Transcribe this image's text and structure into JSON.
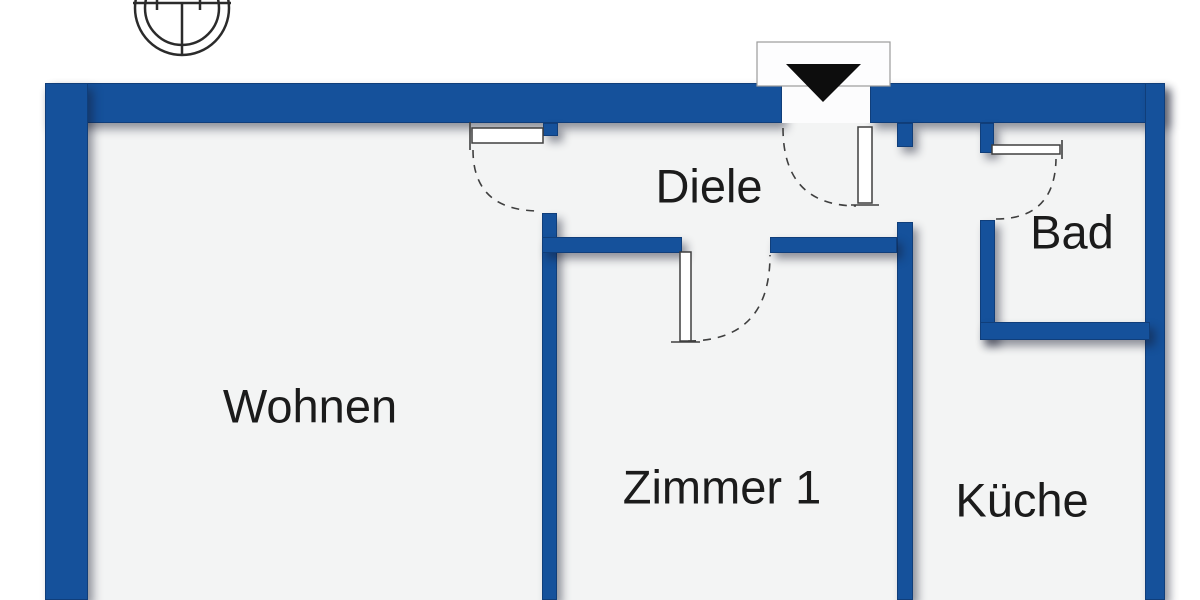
{
  "rooms": [
    {
      "id": "wohnen",
      "label": "Wohnen"
    },
    {
      "id": "diele",
      "label": "Diele"
    },
    {
      "id": "zimmer-1",
      "label": "Zimmer 1"
    },
    {
      "id": "bad",
      "label": "Bad"
    },
    {
      "id": "kueche",
      "label": "Küche"
    }
  ],
  "icons": {
    "compass": "compass-rose",
    "entrance": "entrance-arrow-down"
  },
  "colors": {
    "wall": "#15519B",
    "floor": "#F3F4F4",
    "background": "#FFFFFF",
    "text": "#1B1B1B",
    "door_line": "#3F3F3F",
    "entrance_arrow": "#0D0D0D"
  }
}
